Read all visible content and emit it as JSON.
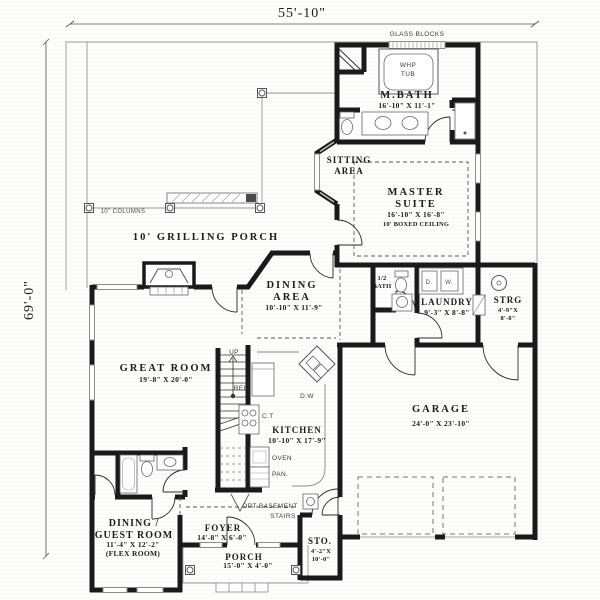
{
  "meta": {
    "background": "#fefefd",
    "wall_color": "#1a1a1a",
    "line_color": "#9a9791",
    "text_color": "#1c1c1c"
  },
  "dimensions": {
    "overall_width": "55'-10\"",
    "overall_height": "69'-0\""
  },
  "annotations": {
    "glass_blocks": "GLASS BLOCKS",
    "columns_note": "10\" COLUMNS",
    "up": "UP",
    "opt_basement_line1": "OPT BASEMENT",
    "opt_basement_line2": "STAIRS"
  },
  "rooms": {
    "grilling_porch": {
      "name": "10' GRILLING PORCH"
    },
    "mbath": {
      "name": "M.BATH",
      "dims": "16'-10\" X 11'-1\""
    },
    "master": {
      "line1": "MASTER",
      "line2": "SUITE",
      "dims": "16'-10\" X 16'-8\"",
      "note": "10' BOXED CEILING"
    },
    "sitting": {
      "line1": "SITTING",
      "line2": "AREA"
    },
    "dining": {
      "line1": "DINING",
      "line2": "AREA",
      "dims": "10'-10\" X 11'-9\""
    },
    "half_bath": {
      "line1": "1/2",
      "line2": "BATH"
    },
    "laundry": {
      "name": "LAUNDRY",
      "dims": "9'-3\" X 8'-8\""
    },
    "strg": {
      "name": "STRG",
      "dims_line1": "4'-9\"X",
      "dims_line2": "8'-8\""
    },
    "great_room": {
      "name": "GREAT ROOM",
      "dims": "19'-8\" X 20'-0\""
    },
    "kitchen": {
      "name": "KITCHEN",
      "dims": "10'-10\" X 17'-9\""
    },
    "garage": {
      "name": "GARAGE",
      "dims": "24'-0\" X 23'-10\""
    },
    "sto": {
      "name": "STO.",
      "dims_line1": "4'-2\"X",
      "dims_line2": "10'-0\""
    },
    "dining_guest": {
      "line1": "DINING /",
      "line2": "GUEST ROOM",
      "dims": "11'-4\" X 12'-2\"",
      "note": "(FLEX ROOM)"
    },
    "foyer": {
      "name": "FOYER",
      "dims": "14'-8\" X 6'-0\""
    },
    "porch": {
      "name": "PORCH",
      "dims": "15'-0\" X 4'-0\""
    }
  },
  "appliances": {
    "whp_line1": "WHP",
    "whp_line2": "TUB",
    "ref": "REF",
    "cooktop": "C.T",
    "dishwasher": "D.W",
    "oven": "OVEN",
    "pantry": "PAN.",
    "dryer": "D.",
    "washer": "W."
  }
}
